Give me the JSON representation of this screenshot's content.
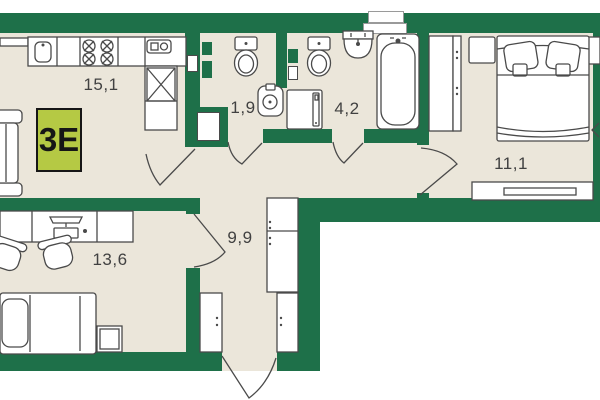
{
  "unit": {
    "badge": "3E"
  },
  "rooms": [
    {
      "name": "kitchen-living",
      "area": "15,1"
    },
    {
      "name": "bathroom-guest",
      "area": "1,9"
    },
    {
      "name": "bathroom-main",
      "area": "4,2"
    },
    {
      "name": "bedroom",
      "area": "11,1"
    },
    {
      "name": "hallway",
      "area": "9,9"
    },
    {
      "name": "bedroom-second",
      "area": "13,6"
    }
  ],
  "colors": {
    "wall": "#1e7049",
    "floor": "#ebe6da",
    "badge-bg": "#b5c944",
    "badge-border": "#161616",
    "line": "#4a4a4a",
    "label": "#414141",
    "shaft-outline": "#9a9a9a"
  }
}
